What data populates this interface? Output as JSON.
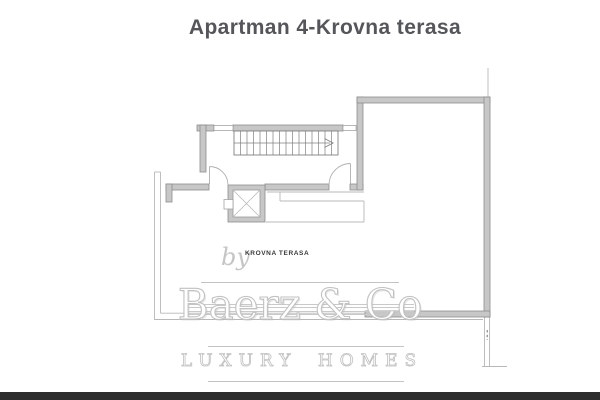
{
  "title": "Apartman 4-Krovna terasa",
  "plan": {
    "room_label": "KROVNA TERASA",
    "symbols": [
      "staircase",
      "elevator-shaft",
      "door-swing",
      "window-opening",
      "terrace-parapet"
    ],
    "colors": {
      "wall_fill": "#c7c7c7",
      "wall_edge": "#8d8d8d",
      "thin_line": "#b8b8b8",
      "stair_line": "#808080",
      "door_arc": "#b0b0b0",
      "dashed_opening": "#6f6f6f",
      "room_label_text": "#3a3a3a"
    }
  },
  "watermark": {
    "prefix": "by",
    "brand": "Baerz & Co",
    "tagline": "LUXURY HOMES",
    "color": "#c4c4c4"
  },
  "page": {
    "title_color": "#55565a",
    "background": "#ffffff",
    "bottom_bar_color": "#2d2d2d"
  }
}
